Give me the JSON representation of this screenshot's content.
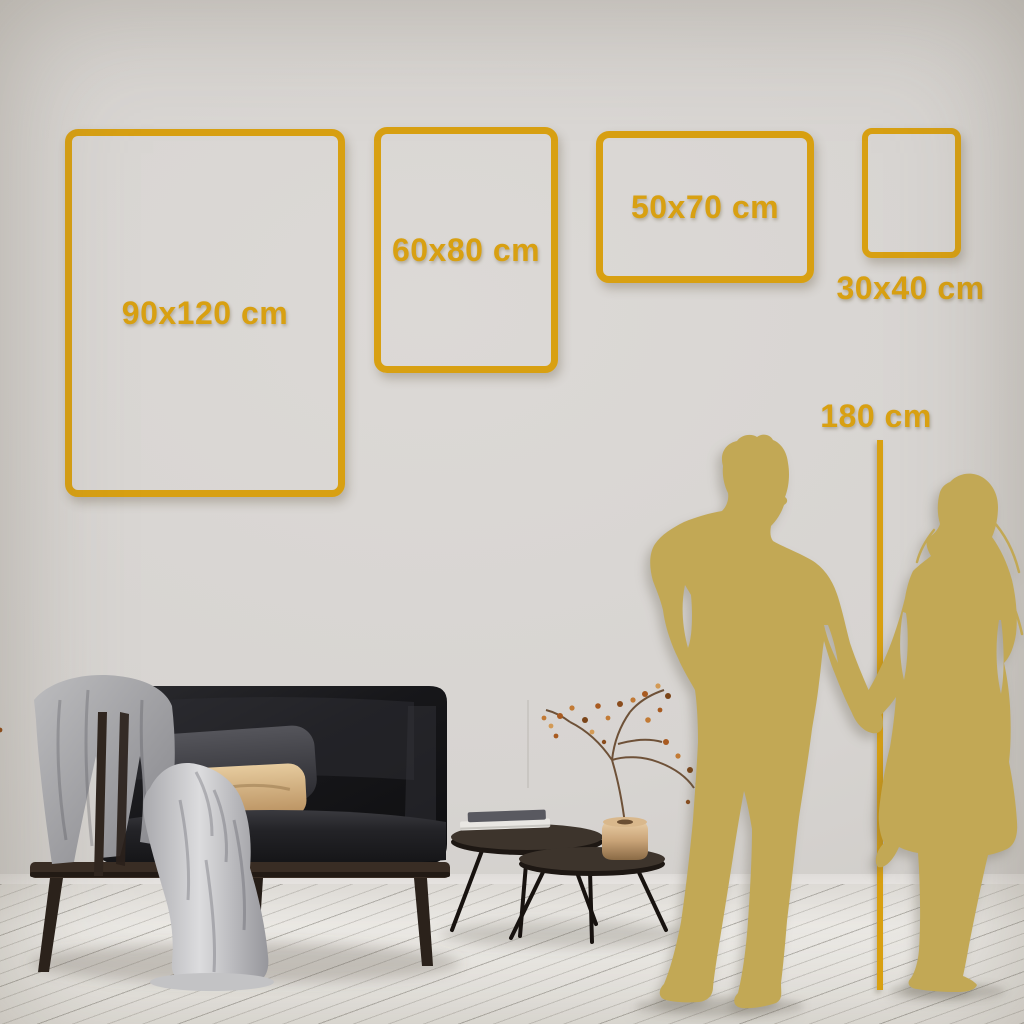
{
  "frames": [
    {
      "label": "90x120 cm"
    },
    {
      "label": "60x80 cm"
    },
    {
      "label": "50x70 cm"
    },
    {
      "label": "30x40 cm"
    }
  ],
  "height_marker": {
    "label": "180 cm"
  },
  "palette": {
    "accent_gold": "#D8A012",
    "silhouette_gold": "#C2A855",
    "wall": "#D7D4D1",
    "floor": "#EDEBE7",
    "sofa_dark": "#141416",
    "wood": "#3B2E25",
    "pillow_tan": "#D8B483"
  },
  "scene": {
    "sofa": "dark-velvet-loveseat-with-gray-throw",
    "tables": "nesting-round-coffee-tables",
    "decor_books": "stacked-books",
    "decor_vase": "brass-vase-with-dried-branch",
    "figures": "man-and-woman-holding-hands-silhouette"
  }
}
